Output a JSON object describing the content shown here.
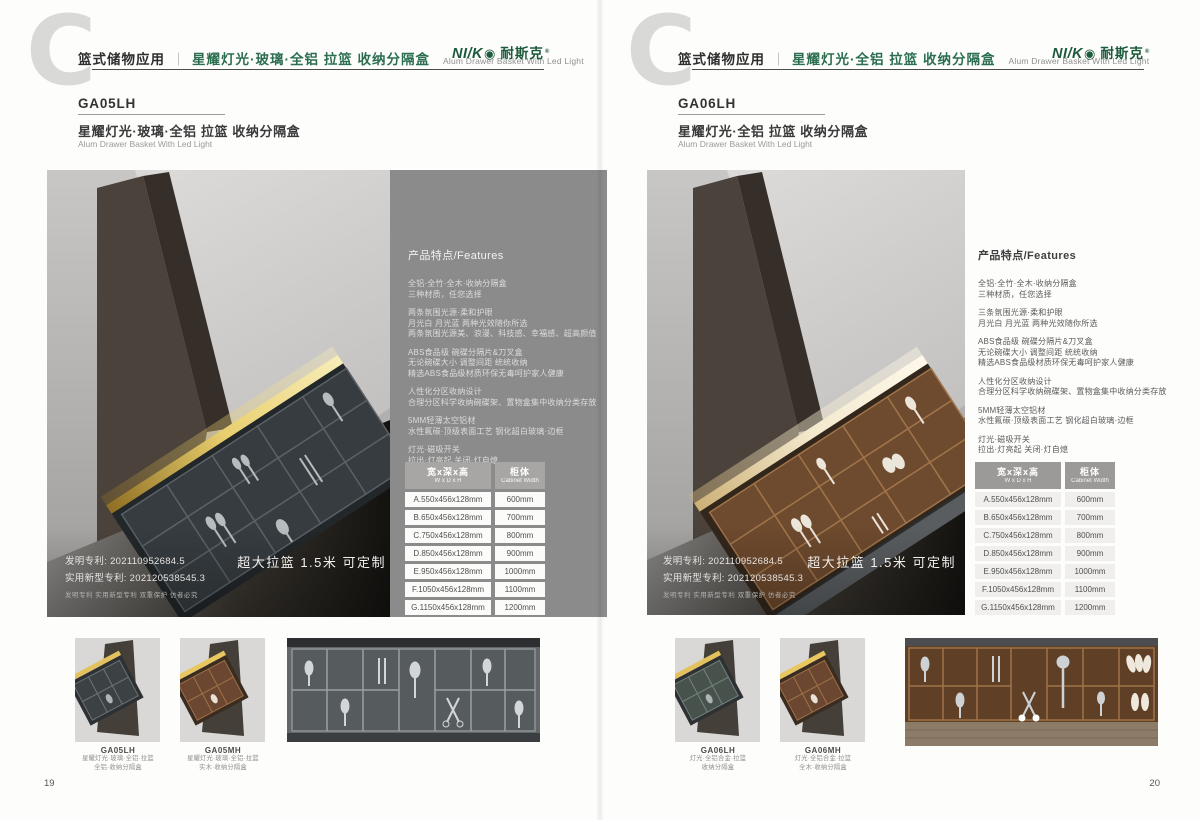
{
  "brand": {
    "logo_en": "NI/K",
    "logo_o": "◉",
    "logo_cn": "耐斯克",
    "logo_reg": "®",
    "logo_color": "#1d5a3c"
  },
  "accent_green": "#2c6e50",
  "page": {
    "left": {
      "page_number": "19",
      "header": {
        "letter": "C",
        "category": "篮式储物应用",
        "title_cn": "星耀灯光·玻璃·全铝 拉篮 收纳分隔盒",
        "title_en": "Alum Drawer Basket With Led Light"
      },
      "product": {
        "code": "GA05LH",
        "name_cn": "星耀灯光·玻璃·全铝 拉篮  收纳分隔盒",
        "name_en": "Alum Drawer Basket With Led Light"
      },
      "features": {
        "heading": "产品特点/Features",
        "groups": [
          {
            "lines": [
              "全铝·全竹·全木·收纳分隔盒",
              "三种材质，任您选择"
            ]
          },
          {
            "lines": [
              "两条氛围光源·柔和护眼",
              "月光白 月光蓝 两种光效随你所选",
              "两条氛围光源美、浪漫、科技感、幸福感、超高颜值"
            ]
          },
          {
            "lines": [
              "ABS食品级 碗碟分隔片&刀叉盒",
              "无论碗碟大小 调整间距 统统收纳",
              "精选ABS食品级材质环保无毒呵护家人健康"
            ]
          },
          {
            "lines": [
              "人性化分区收纳设计",
              "合理分区科学收纳碗碟架、置物盒集中收纳分类存放"
            ]
          },
          {
            "lines": [
              "5MM轻薄太空铝材",
              "水性氟碳·顶级表面工艺 钢化超白玻璃·边框"
            ]
          },
          {
            "lines": [
              "灯光·磁吸开关",
              "拉出·灯亮起 关闭·灯自熄"
            ]
          }
        ]
      },
      "patent": {
        "line1": "发明专利: 202110952684.5",
        "line2": "实用新型专利: 202120538545.3",
        "line3": "发明专利 实用新型专利 双重保护 仿者必究"
      },
      "banner": "超大拉篮 1.5米 可定制",
      "spec_table": {
        "col1_cn": "宽x深x高",
        "col1_en": "W x D x H",
        "col2_cn": "柜体",
        "col2_en": "Cabinet Width",
        "rows": [
          {
            "size": "A.550x456x128mm",
            "cabinet": "600mm"
          },
          {
            "size": "B.650x456x128mm",
            "cabinet": "700mm"
          },
          {
            "size": "C.750x456x128mm",
            "cabinet": "800mm"
          },
          {
            "size": "D.850x456x128mm",
            "cabinet": "900mm"
          },
          {
            "size": "E.950x456x128mm",
            "cabinet": "1000mm"
          },
          {
            "size": "F.1050x456x128mm",
            "cabinet": "1100mm"
          },
          {
            "size": "G.1150x456x128mm",
            "cabinet": "1200mm"
          }
        ]
      },
      "thumbnails": [
        {
          "code": "GA05LH",
          "line1": "星耀灯光·玻璃·全铝·拉篮",
          "line2": "全铝·收纳分隔盒"
        },
        {
          "code": "GA05MH",
          "line1": "星耀灯光·玻璃·全铝·拉篮",
          "line2": "实木·收纳分隔盒"
        }
      ]
    },
    "right": {
      "page_number": "20",
      "header": {
        "letter": "C",
        "category": "篮式储物应用",
        "title_cn": "星耀灯光·全铝 拉篮 收纳分隔盒",
        "title_en": "Alum Drawer Basket With Led Light"
      },
      "product": {
        "code": "GA06LH",
        "name_cn": "星耀灯光·全铝 拉篮 收纳分隔盒",
        "name_en": "Alum Drawer Basket With Led Light"
      },
      "features": {
        "heading": "产品特点/Features",
        "groups": [
          {
            "lines": [
              "全铝·全竹·全木·收纳分隔盒",
              "三种材质，任您选择"
            ]
          },
          {
            "lines": [
              "三条氛围光源·柔和护眼",
              "月光白 月光蓝 两种光效随你所选"
            ]
          },
          {
            "lines": [
              "ABS食品级 碗碟分隔片&刀叉盒",
              "无论碗碟大小 调整间距 统统收纳",
              "精选ABS食品级材质环保无毒呵护家人健康"
            ]
          },
          {
            "lines": [
              "人性化分区收纳设计",
              "合理分区科学收纳碗碟架、置物盒集中收纳分类存放"
            ]
          },
          {
            "lines": [
              "5MM轻薄太空铝材",
              "水性氟碳·顶级表面工艺 钢化超白玻璃·边框"
            ]
          },
          {
            "lines": [
              "灯光·磁吸开关",
              "拉出·灯亮起 关闭·灯自熄"
            ]
          }
        ]
      },
      "patent": {
        "line1": "发明专利: 202110952684.5",
        "line2": "实用新型专利: 202120538545.3",
        "line3": "发明专利 实用新型专利 双重保护 仿者必究"
      },
      "banner": "超大拉篮 1.5米 可定制",
      "spec_table": {
        "col1_cn": "宽x深x高",
        "col1_en": "W x D x H",
        "col2_cn": "柜体",
        "col2_en": "Cabinet Width",
        "rows": [
          {
            "size": "A.550x456x128mm",
            "cabinet": "600mm"
          },
          {
            "size": "B.650x456x128mm",
            "cabinet": "700mm"
          },
          {
            "size": "C.750x456x128mm",
            "cabinet": "800mm"
          },
          {
            "size": "D.850x456x128mm",
            "cabinet": "900mm"
          },
          {
            "size": "E.950x456x128mm",
            "cabinet": "1000mm"
          },
          {
            "size": "F.1050x456x128mm",
            "cabinet": "1100mm"
          },
          {
            "size": "G.1150x456x128mm",
            "cabinet": "1200mm"
          }
        ]
      },
      "thumbnails": [
        {
          "code": "GA06LH",
          "line1": "灯光·全铝合金·拉篮",
          "line2": "收纳分隔盒"
        },
        {
          "code": "GA06MH",
          "line1": "灯光·全铝合金·拉篮",
          "line2": "全木·收纳分隔盒"
        }
      ]
    }
  }
}
